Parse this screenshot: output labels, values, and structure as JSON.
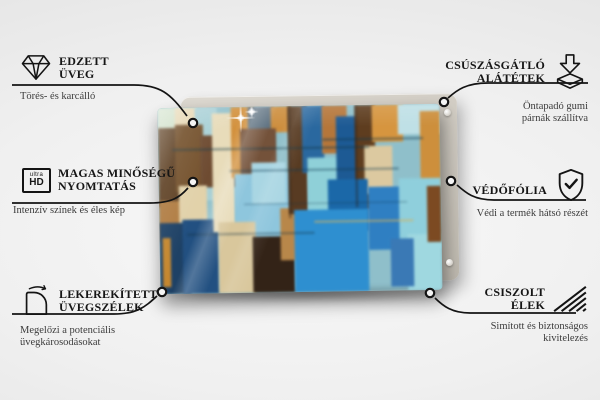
{
  "page": {
    "background_center": "#f8f8f8",
    "background_edge": "#dddddd",
    "line_color": "#141414"
  },
  "product": {
    "description": "abstract painting printed on tempered glass panel over backing board",
    "board_color": "#cfcac1",
    "pin_count": 2,
    "art_blocks": [
      {
        "x": 0,
        "y": 0,
        "w": 14,
        "h": 52,
        "c": "#9ec9cf"
      },
      {
        "x": 0,
        "y": 0,
        "w": 8,
        "h": 13,
        "c": "#cfe0c8"
      },
      {
        "x": 6,
        "y": 0,
        "w": 8,
        "h": 12,
        "c": "#e7d8b4"
      },
      {
        "x": 13,
        "y": 0,
        "w": 8,
        "h": 50,
        "c": "#a8d0d6"
      },
      {
        "x": 0,
        "y": 11,
        "w": 8,
        "h": 42,
        "c": "#5e4023"
      },
      {
        "x": 6,
        "y": 9,
        "w": 10,
        "h": 36,
        "c": "#74512c"
      },
      {
        "x": 15,
        "y": 15,
        "w": 14,
        "h": 28,
        "c": "#6e4b31"
      },
      {
        "x": 0,
        "y": 50,
        "w": 9,
        "h": 22,
        "c": "#b07c42"
      },
      {
        "x": 7,
        "y": 42,
        "w": 10,
        "h": 22,
        "c": "#e2d2aa"
      },
      {
        "x": 0,
        "y": 62,
        "w": 11,
        "h": 38,
        "c": "#1e4165"
      },
      {
        "x": 1,
        "y": 70,
        "w": 3,
        "h": 26,
        "c": "#c5872f"
      },
      {
        "x": 8,
        "y": 60,
        "w": 13,
        "h": 40,
        "c": "#225081"
      },
      {
        "x": 19,
        "y": 3,
        "w": 8,
        "h": 64,
        "c": "#e8dcba"
      },
      {
        "x": 26,
        "y": 0,
        "w": 8,
        "h": 38,
        "c": "#d3913d"
      },
      {
        "x": 32,
        "y": 0,
        "w": 9,
        "h": 30,
        "c": "#5a6e7e"
      },
      {
        "x": 40,
        "y": 0,
        "w": 7,
        "h": 14,
        "c": "#cd8e3e"
      },
      {
        "x": 29,
        "y": 12,
        "w": 13,
        "h": 30,
        "c": "#74523a"
      },
      {
        "x": 27,
        "y": 36,
        "w": 22,
        "h": 38,
        "c": "#8ec6dd"
      },
      {
        "x": 33,
        "y": 30,
        "w": 12,
        "h": 22,
        "c": "#a9d6e3"
      },
      {
        "x": 21,
        "y": 62,
        "w": 13,
        "h": 38,
        "c": "#d9c79c"
      },
      {
        "x": 33,
        "y": 70,
        "w": 15,
        "h": 30,
        "c": "#332317"
      },
      {
        "x": 43,
        "y": 55,
        "w": 8,
        "h": 28,
        "c": "#b8874a"
      },
      {
        "x": 46,
        "y": 0,
        "w": 7,
        "h": 58,
        "c": "#583b22"
      },
      {
        "x": 51,
        "y": 0,
        "w": 8,
        "h": 36,
        "c": "#2a689f"
      },
      {
        "x": 53,
        "y": 28,
        "w": 12,
        "h": 30,
        "c": "#8fd0d8"
      },
      {
        "x": 58,
        "y": 0,
        "w": 9,
        "h": 26,
        "c": "#b5763a"
      },
      {
        "x": 63,
        "y": 6,
        "w": 12,
        "h": 48,
        "c": "#1d5a94"
      },
      {
        "x": 70,
        "y": 0,
        "w": 7,
        "h": 56,
        "c": "#5e3d1f"
      },
      {
        "x": 76,
        "y": 0,
        "w": 11,
        "h": 20,
        "c": "#d6953f"
      },
      {
        "x": 85,
        "y": 0,
        "w": 15,
        "h": 16,
        "c": "#bfe0e6"
      },
      {
        "x": 93,
        "y": 4,
        "w": 7,
        "h": 40,
        "c": "#cd8f3c"
      },
      {
        "x": 73,
        "y": 22,
        "w": 10,
        "h": 26,
        "c": "#dcc9a0"
      },
      {
        "x": 60,
        "y": 40,
        "w": 14,
        "h": 28,
        "c": "#1b68a8"
      },
      {
        "x": 48,
        "y": 56,
        "w": 26,
        "h": 44,
        "c": "#2e8fd0"
      },
      {
        "x": 74,
        "y": 44,
        "w": 14,
        "h": 34,
        "c": "#2f7fc2"
      },
      {
        "x": 85,
        "y": 40,
        "w": 15,
        "h": 38,
        "c": "#8fcfdc"
      },
      {
        "x": 88,
        "y": 70,
        "w": 12,
        "h": 30,
        "c": "#9fd8e0"
      },
      {
        "x": 82,
        "y": 72,
        "w": 8,
        "h": 26,
        "c": "#3a79b5"
      },
      {
        "x": 95,
        "y": 44,
        "w": 5,
        "h": 30,
        "c": "#7c4a22"
      },
      {
        "x": 5,
        "y": 22,
        "w": 70,
        "h": 0.9,
        "c": "#123a4a",
        "o": 0.5
      },
      {
        "x": 25,
        "y": 34,
        "w": 60,
        "h": 0.9,
        "c": "#0f3a52",
        "o": 0.45
      },
      {
        "x": 30,
        "y": 52,
        "w": 58,
        "h": 0.9,
        "c": "#0d3248",
        "o": 0.4
      },
      {
        "x": 10,
        "y": 68,
        "w": 45,
        "h": 0.9,
        "c": "#123040",
        "o": 0.4
      },
      {
        "x": 55,
        "y": 62,
        "w": 35,
        "h": 0.8,
        "c": "#d8b25a",
        "o": 0.6
      },
      {
        "x": 58,
        "y": 18,
        "w": 36,
        "h": 0.9,
        "c": "#0f3a52",
        "o": 0.5
      },
      {
        "x": 46,
        "y": 0,
        "w": 0.7,
        "h": 60,
        "c": "#2a1a10",
        "o": 0.5
      },
      {
        "x": 70,
        "y": 0,
        "w": 0.7,
        "h": 55,
        "c": "#2a1a10",
        "o": 0.45
      }
    ]
  },
  "callouts": {
    "tempered_glass": {
      "icon": "diamond-icon",
      "title_line1": "EDZETT",
      "title_line2": "ÜVEG",
      "subtext": "Törés- és karcálló"
    },
    "high_quality_print": {
      "icon": "ultra-hd-icon",
      "icon_label_top": "ultra",
      "icon_label_bottom": "HD",
      "title_line1": "MAGAS MINŐSÉGŰ",
      "title_line2": "NYOMTATÁS",
      "subtext": "Intenzív színek és éles kép"
    },
    "rounded_glass_edges": {
      "icon": "rounded-corners-icon",
      "title_line1": "LEKEREKÍTETT",
      "title_line2": "ÜVEGSZÉLEK",
      "subtext_line1": "Megelőzi a potenciális",
      "subtext_line2": "üvegkárosodásokat"
    },
    "anti_slip_pads": {
      "icon": "anti-slip-pads-icon",
      "title_line1": "CSÚSZÁSGÁTLÓ",
      "title_line2": "ALÁTÉTEK",
      "subtext_line1": "Öntapadó gumi",
      "subtext_line2": "párnák szállítva"
    },
    "protective_film": {
      "icon": "shield-check-icon",
      "title": "VÉDŐFÓLIA",
      "subtext": "Védi a termék hátsó részét"
    },
    "polished_edges": {
      "icon": "polished-edges-icon",
      "title_line1": "CSISZOLT",
      "title_line2": "ÉLEK",
      "subtext_line1": "Simított és biztonságos",
      "subtext_line2": "kivitelezés"
    }
  }
}
